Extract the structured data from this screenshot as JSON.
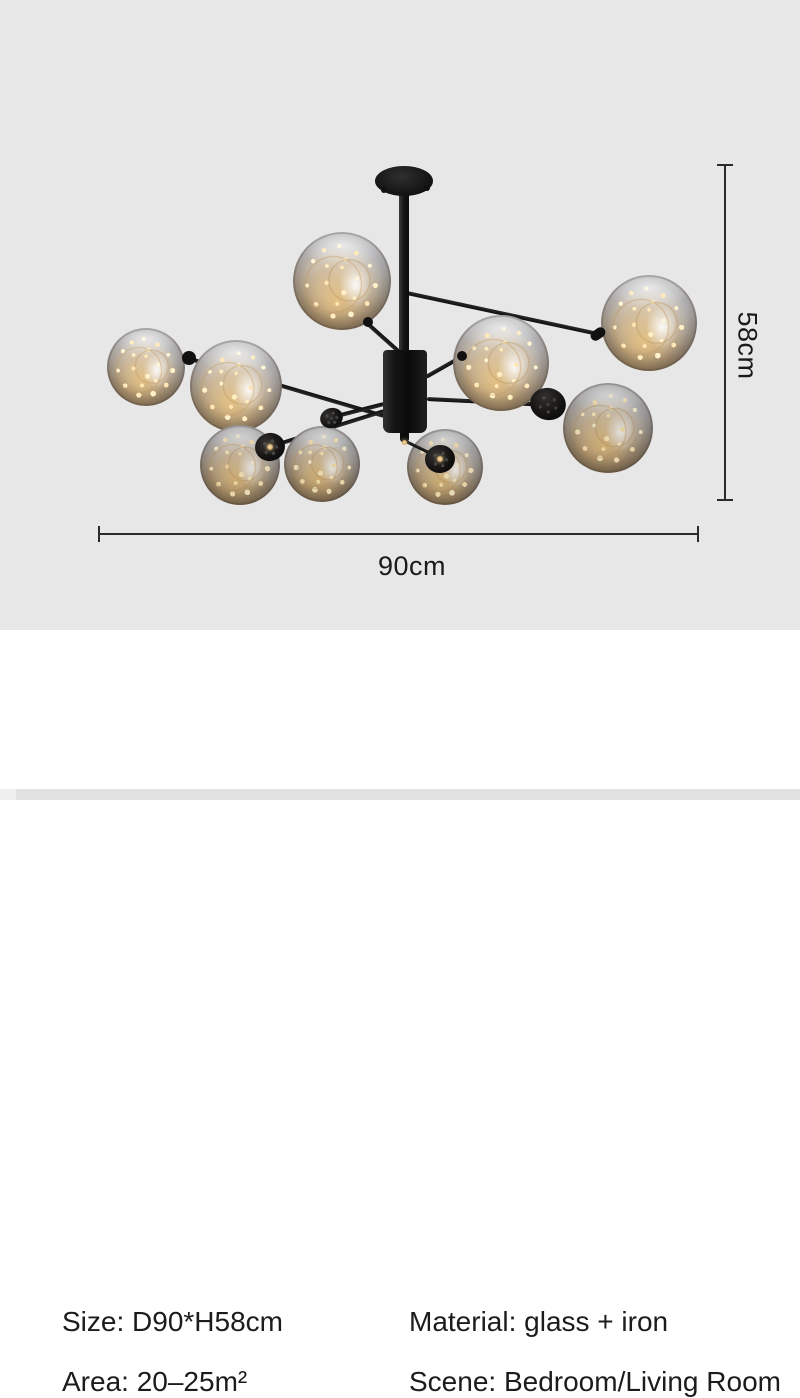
{
  "photo": {
    "alt": "black iron sputnik chandelier with smoked glass globes and fairy lights",
    "width_dimension": "90cm",
    "height_dimension": "58cm"
  },
  "specs": {
    "size": "Size: D90*H58cm",
    "material": "Material: glass + iron",
    "area": "Area: 20–25m²",
    "scene": "Scene: Bedroom/Living Room"
  },
  "colors": {
    "photo_background": "#e7e7e8",
    "panel_background": "#ffffff",
    "metal_black": "#141414",
    "glass_warm_glow": "#c9a36a",
    "dimension_line": "#2b2b2b",
    "text": "#1c1c1c",
    "bottom_strip": "#e2e2e3"
  }
}
